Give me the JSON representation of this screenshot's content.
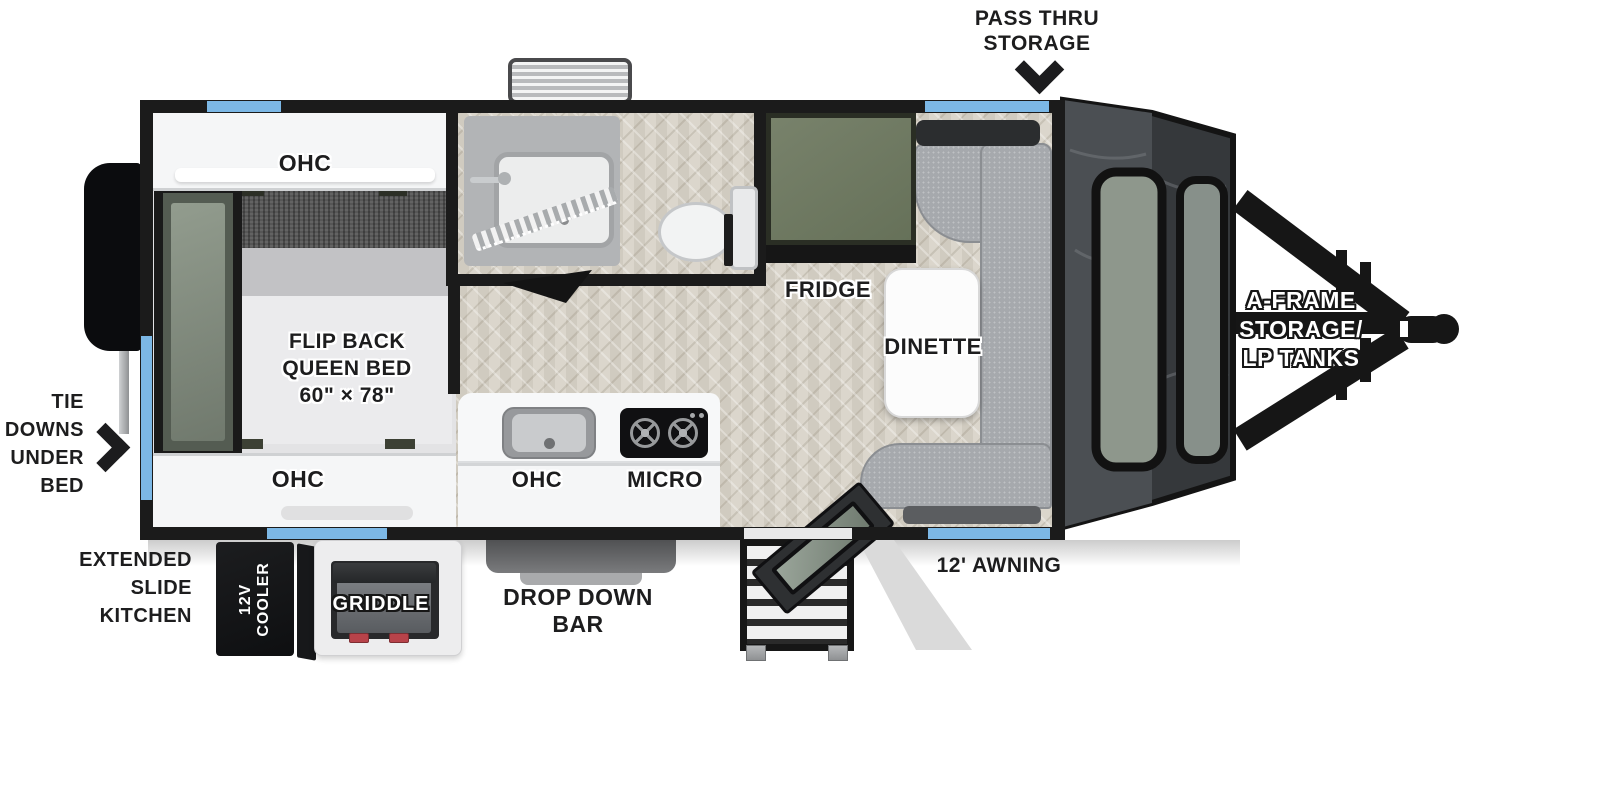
{
  "figure": {
    "type": "travel-trailer floorplan, top-down view"
  },
  "colors": {
    "accent_blue": "#7cb8e6",
    "wall_black": "#1b1b1b",
    "fridge_olive": "#6f7963",
    "bench_gray": "#a6a9ad",
    "wood_floor": "#d8d3c8",
    "label_dark": "#1d1d1e",
    "label_white": "#ffffff"
  },
  "callouts": {
    "pass_thru": {
      "line1": "PASS THRU",
      "line2": "STORAGE"
    },
    "tie_downs": {
      "line1": "TIE",
      "line2": "DOWNS",
      "line3": "UNDER",
      "line4": "BED"
    },
    "extended_slide": {
      "line1": "EXTENDED",
      "line2": "SLIDE",
      "line3": "KITCHEN"
    },
    "drop_down_bar": {
      "line1": "DROP DOWN",
      "line2": "BAR"
    },
    "awning": "12' AWNING",
    "a_frame": {
      "line1": "A-FRAME",
      "line2": "STORAGE/",
      "line3": "LP TANKS"
    }
  },
  "interior": {
    "ohc_bed_top": "OHC",
    "ohc_bed_bottom": "OHC",
    "bed": {
      "line1": "FLIP BACK",
      "line2": "QUEEN BED",
      "line3": "60\" × 78\""
    },
    "ohc_kitchen": "OHC",
    "micro": "MICRO",
    "fridge": "FRIDGE",
    "dinette": "DINETTE"
  },
  "exterior": {
    "cooler": {
      "line1": "12V",
      "line2": "COOLER"
    },
    "griddle": "GRIDDLE"
  }
}
